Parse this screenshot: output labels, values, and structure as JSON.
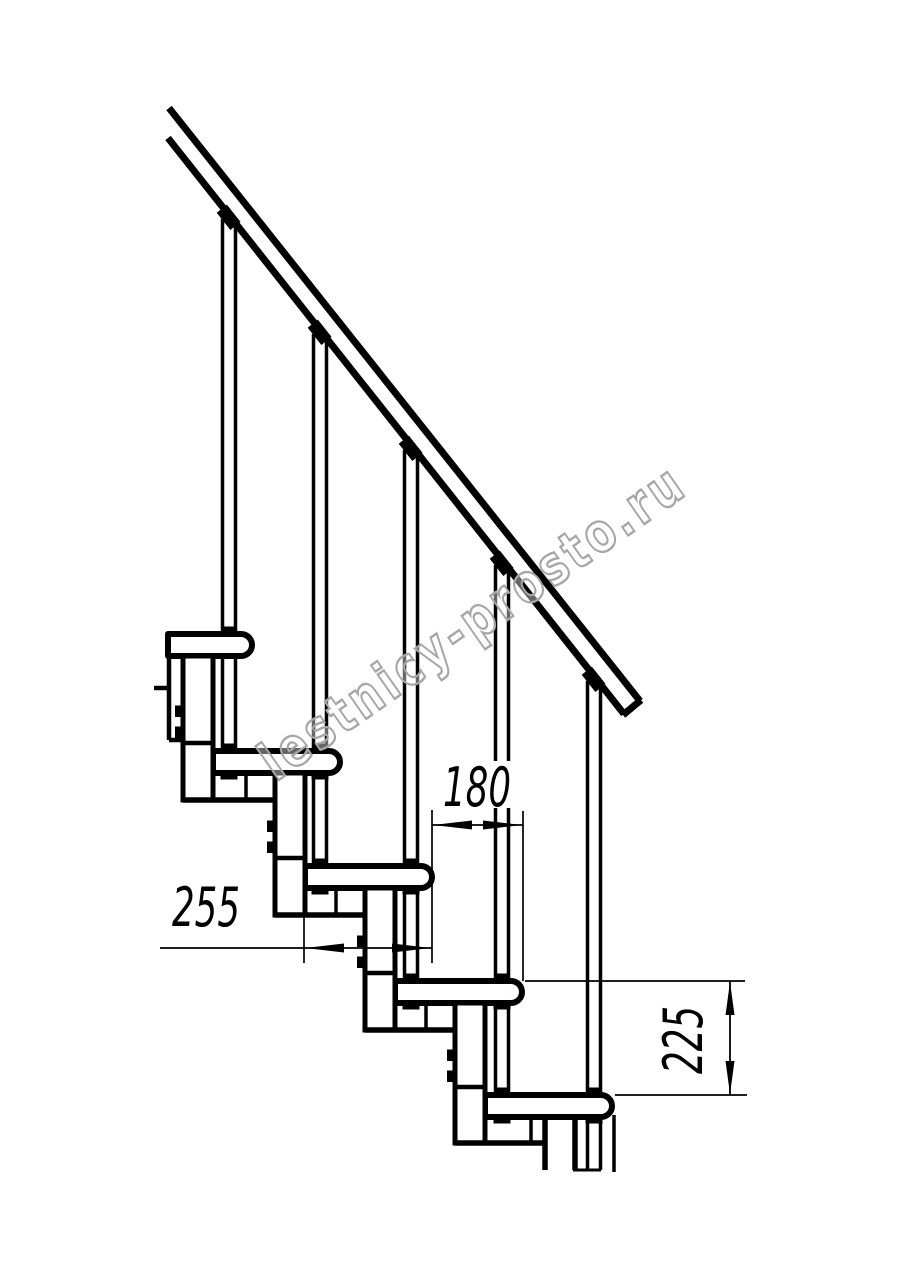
{
  "watermark": {
    "text": "lestnicy-prosto.ru"
  },
  "dimensions": {
    "going": "180",
    "tread_depth": "255",
    "rise": "225"
  }
}
